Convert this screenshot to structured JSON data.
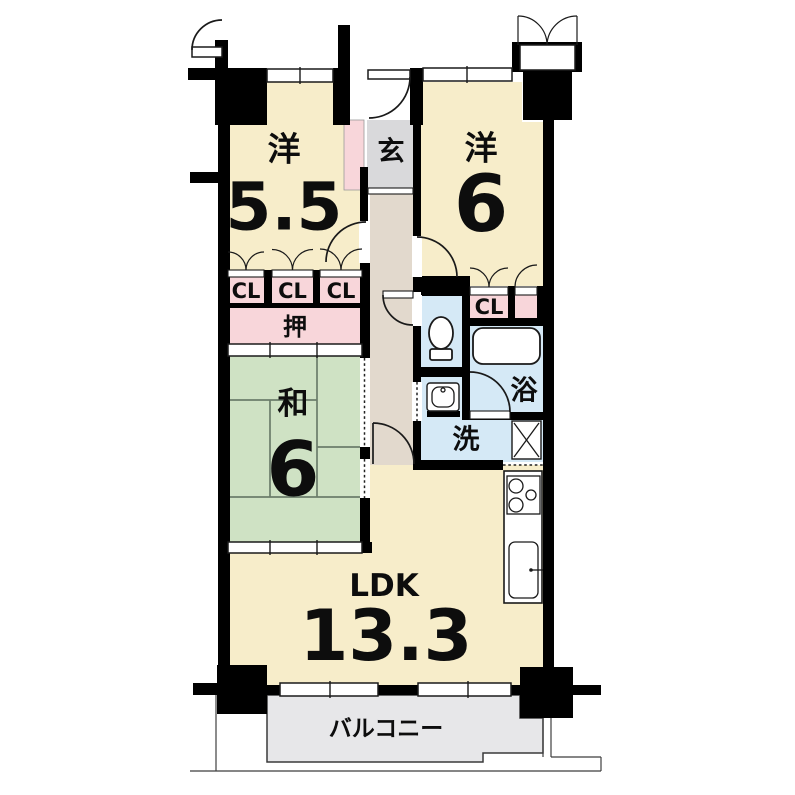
{
  "title": "マンション間取り図 3LDK",
  "colors": {
    "cream": "#f7edca",
    "pink": "#f8d6da",
    "green": "#cfe2c4",
    "blue": "#d5e9f6",
    "gray": "#d9d9db",
    "hall": "#e2d9cd",
    "balcony": "#e7e7e9",
    "wall": "#000000",
    "tatami-line": "#6b7d6b"
  },
  "rooms": {
    "western_a": {
      "label": "洋",
      "size": "5.5"
    },
    "western_b": {
      "label": "洋",
      "size": "6"
    },
    "entrance": {
      "label": "玄"
    },
    "japanese": {
      "label": "和",
      "size": "6"
    },
    "oshiire": {
      "label": "押"
    },
    "bath": {
      "label": "浴"
    },
    "washroom": {
      "label": "洗"
    },
    "ldk": {
      "label": "LDK",
      "size": "13.3"
    },
    "balcony": {
      "label": "バルコニー"
    }
  },
  "closets": {
    "cl1": "CL",
    "cl2": "CL",
    "cl3": "CL",
    "cl4": "CL"
  }
}
